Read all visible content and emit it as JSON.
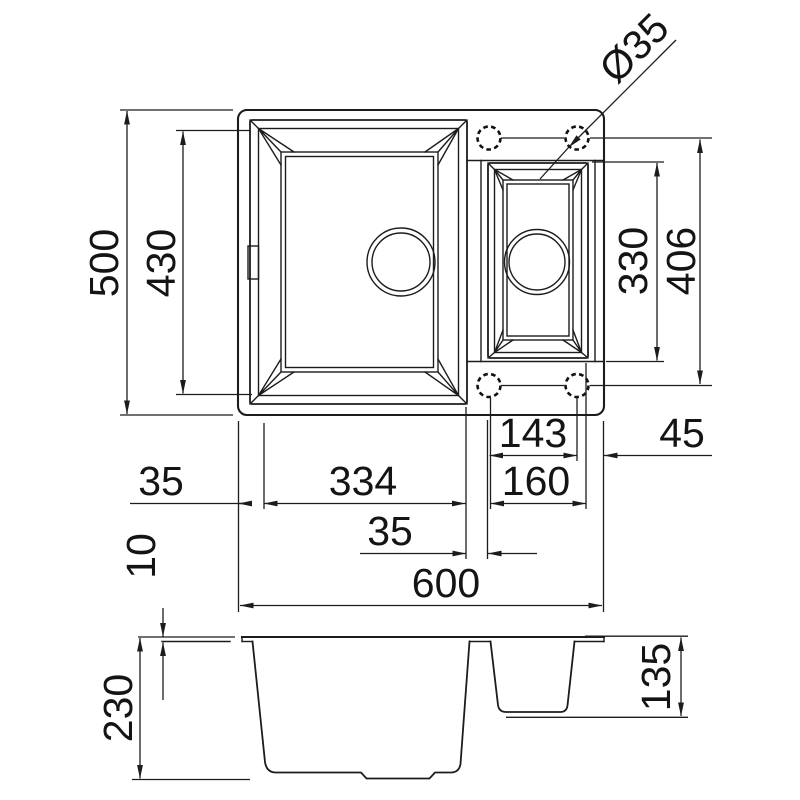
{
  "drawing": {
    "title": "1.5 bowl sink technical drawing",
    "units": "mm",
    "colors": {
      "line": "#1c1c1c",
      "background": "#ffffff"
    },
    "top_view": {
      "overall_width_label": "600",
      "overall_depth_label": "500",
      "bowl_length_label": "430",
      "left_rim_offset_label": "35",
      "main_bowl_width_label": "334",
      "bowl_gap_label": "35",
      "small_bowl_length_label": "330",
      "tap_hole_span_label": "406",
      "tap_hole_pitch_label": "143",
      "tap_hole_edge_offset_label": "45",
      "small_bowl_offset_label": "160",
      "tap_hole_diameter_label": "Ø35",
      "tap_hole_count": 4
    },
    "side_view": {
      "rim_thickness_label": "10",
      "main_bowl_depth_label": "230",
      "small_bowl_depth_label": "135"
    }
  }
}
